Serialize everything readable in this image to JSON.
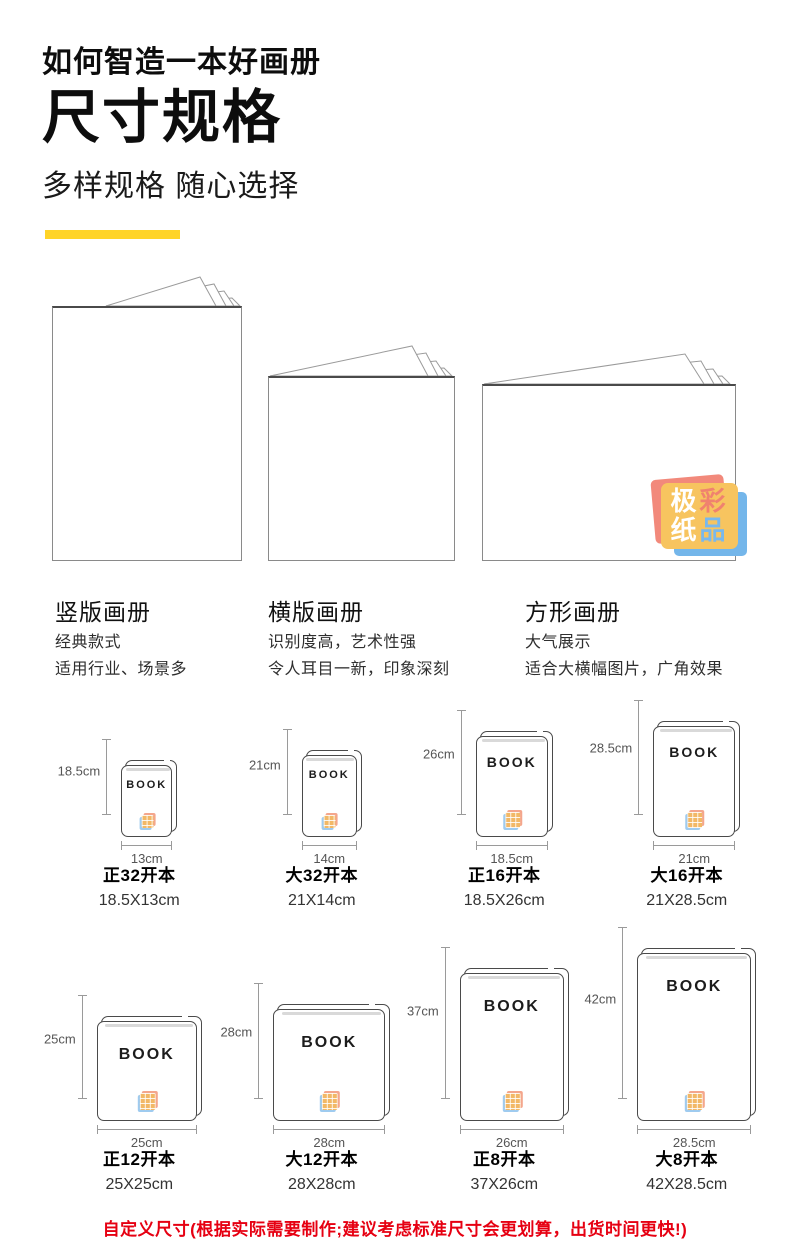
{
  "header": {
    "kicker": "如何智造一本好画册",
    "title": "尺寸规格",
    "subtitle": "多样规格 随心选择"
  },
  "albums": [
    {
      "name": "竖版画册",
      "desc1": "经典款式",
      "desc2": "适用行业、场景多"
    },
    {
      "name": "横版画册",
      "desc1": "识别度高，艺术性强",
      "desc2": "令人耳目一新，印象深刻"
    },
    {
      "name": "方形画册",
      "desc1": "大气展示",
      "desc2": "适合大横幅图片，广角效果"
    }
  ],
  "stamp": {
    "chars": [
      "极",
      "彩",
      "纸",
      "品"
    ]
  },
  "book_cover_label": "BOOK",
  "sizes": [
    {
      "name": "正32开本",
      "dims": "18.5X13cm",
      "height_label": "18.5cm",
      "width_label": "13cm"
    },
    {
      "name": "大32开本",
      "dims": "21X14cm",
      "height_label": "21cm",
      "width_label": "14cm"
    },
    {
      "name": "正16开本",
      "dims": "18.5X26cm",
      "height_label": "26cm",
      "width_label": "18.5cm"
    },
    {
      "name": "大16开本",
      "dims": "21X28.5cm",
      "height_label": "28.5cm",
      "width_label": "21cm"
    },
    {
      "name": "正12开本",
      "dims": "25X25cm",
      "height_label": "25cm",
      "width_label": "25cm"
    },
    {
      "name": "大12开本",
      "dims": "28X28cm",
      "height_label": "28cm",
      "width_label": "28cm"
    },
    {
      "name": "正8开本",
      "dims": "37X26cm",
      "height_label": "37cm",
      "width_label": "26cm"
    },
    {
      "name": "大8开本",
      "dims": "42X28.5cm",
      "height_label": "42cm",
      "width_label": "28.5cm"
    }
  ],
  "footer": {
    "note": "自定义尺寸(根据实际需要制作;建议考虑标准尺寸会更划算，出货时间更快!)"
  },
  "colors": {
    "accent_yellow": "#FFD428",
    "note_red": "#E60012",
    "stamp_yellow": "#F7C45F",
    "stamp_red": "#F2897B",
    "stamp_blue": "#74B6EA"
  }
}
